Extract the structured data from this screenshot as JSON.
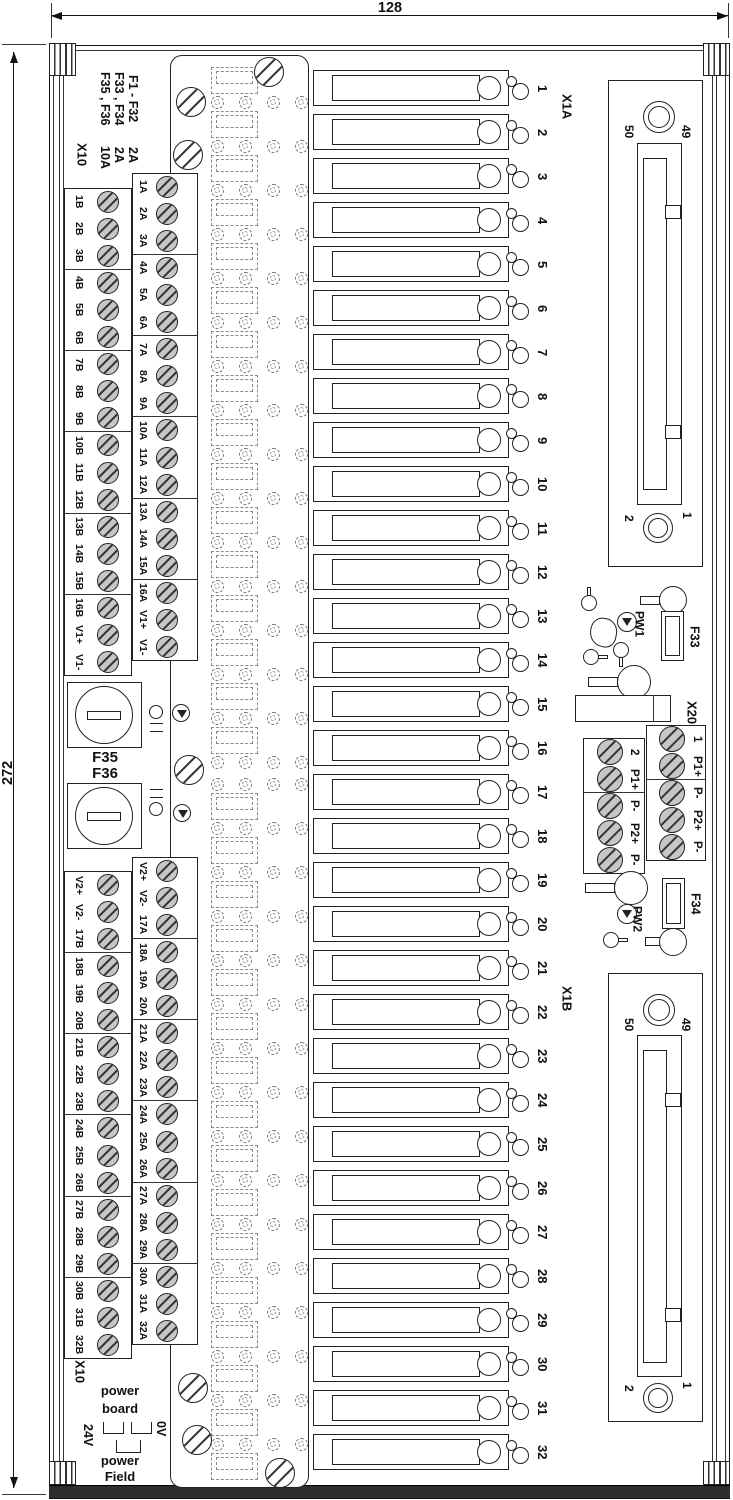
{
  "dimensions": {
    "width_label": "128",
    "height_label": "272"
  },
  "legend": {
    "rows": [
      {
        "fuses": "F1 - F32",
        "rating": "2A"
      },
      {
        "fuses": "F33 , F34",
        "rating": "2A"
      },
      {
        "fuses": "F35 , F36",
        "rating": "10A"
      }
    ],
    "connector_label": "X10"
  },
  "terminals": {
    "upper_b": [
      "1B",
      "2B",
      "3B",
      "4B",
      "5B",
      "6B",
      "7B",
      "8B",
      "9B",
      "10B",
      "11B",
      "12B",
      "13B",
      "14B",
      "15B",
      "16B",
      "V1+",
      "V1-"
    ],
    "upper_a": [
      "1A",
      "2A",
      "3A",
      "4A",
      "5A",
      "6A",
      "7A",
      "8A",
      "9A",
      "10A",
      "11A",
      "12A",
      "13A",
      "14A",
      "15A",
      "16A",
      "V1+",
      "V1-"
    ],
    "lower_a": [
      "V2+",
      "V2-",
      "17A",
      "18A",
      "19A",
      "20A",
      "21A",
      "22A",
      "23A",
      "24A",
      "25A",
      "26A",
      "27A",
      "28A",
      "29A",
      "30A",
      "31A",
      "32A"
    ],
    "lower_b": [
      "V2+",
      "V2-",
      "17B",
      "18B",
      "19B",
      "20B",
      "21B",
      "22B",
      "23B",
      "24B",
      "25B",
      "26B",
      "27B",
      "28B",
      "29B",
      "30B",
      "31B",
      "32B"
    ]
  },
  "fuse_rows": {
    "count": 32,
    "numbers": [
      "1",
      "2",
      "3",
      "4",
      "5",
      "6",
      "7",
      "8",
      "9",
      "10",
      "11",
      "12",
      "13",
      "14",
      "15",
      "16",
      "17",
      "18",
      "19",
      "20",
      "21",
      "22",
      "23",
      "24",
      "25",
      "26",
      "27",
      "28",
      "29",
      "30",
      "31",
      "32"
    ]
  },
  "fuse_holders": {
    "f35": "F35",
    "f36": "F36"
  },
  "fuses_aux": {
    "f33": "F33",
    "f34": "F34"
  },
  "leds": {
    "pw1": "PW1",
    "pw2": "PW2"
  },
  "x1a": {
    "label": "X1A",
    "pin_top_left": "50",
    "pin_top_right": "49",
    "pin_bottom_left": "2",
    "pin_bottom_right": "1"
  },
  "x1b": {
    "label": "X1B",
    "pin_top_left": "50",
    "pin_top_right": "49",
    "pin_bottom_left": "2",
    "pin_bottom_right": "1"
  },
  "x20": {
    "label": "X20",
    "right_col": [
      "1",
      "P1+",
      "P-",
      "P2+",
      "P-"
    ],
    "left_col": [
      "2",
      "P1+",
      "P-",
      "P2+",
      "P-"
    ]
  },
  "power": {
    "title_line1": "power",
    "title_line2": "board",
    "left_rail": "24V",
    "right_rail": "0V",
    "field_line1": "power",
    "field_line2": "Field"
  },
  "colors": {
    "line": "#111111",
    "screw_fill": "#c6c6c6",
    "band": "#2e2e2e",
    "dashed": "#8a8a8a"
  }
}
